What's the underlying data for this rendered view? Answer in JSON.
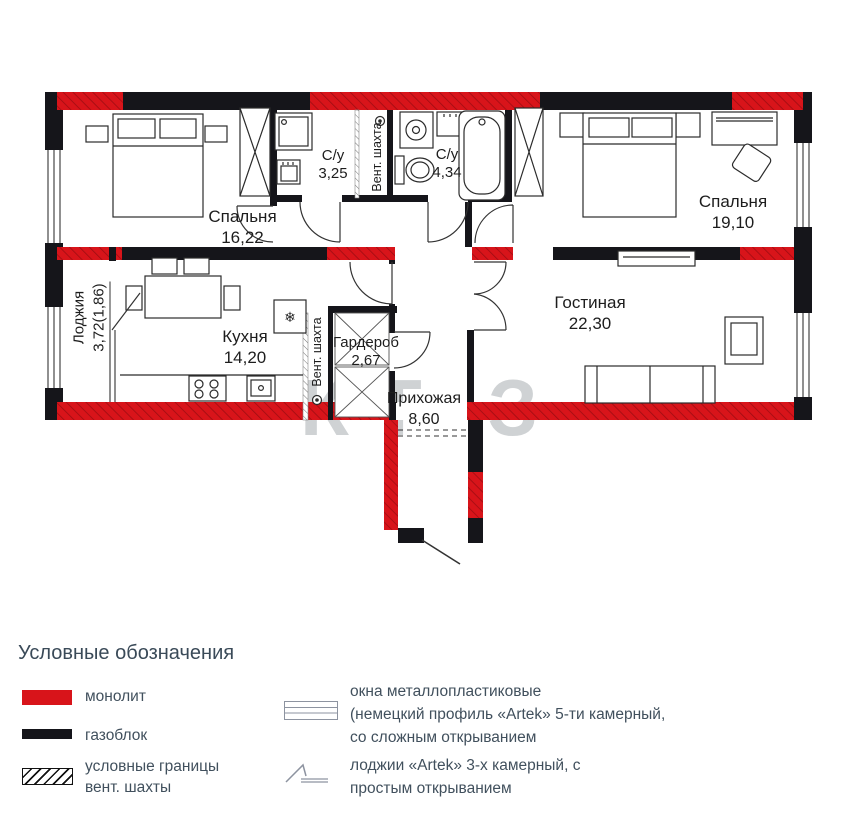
{
  "plan": {
    "rooms": {
      "bedroom1": {
        "name": "Спальня",
        "area": "16,22"
      },
      "bath1": {
        "name": "С/у",
        "area": "3,25"
      },
      "bath2": {
        "name": "С/у",
        "area": "4,34"
      },
      "bedroom2": {
        "name": "Спальня",
        "area": "19,10"
      },
      "living": {
        "name": "Гостиная",
        "area": "22,30"
      },
      "kitchen": {
        "name": "Кухня",
        "area": "14,20"
      },
      "wardrobe": {
        "name": "Гардероб",
        "area": "2,67"
      },
      "hallway": {
        "name": "Прихожая",
        "area": "8,60"
      },
      "loggia": {
        "name": "Лоджия",
        "area": "3,72(1,86)"
      }
    },
    "vent_shaft_top": "Вент. шахта",
    "vent_shaft_kitchen": "Вент. шахта",
    "fridge_icon": "❄",
    "watermark": "КТ З"
  },
  "legend": {
    "title": "Условные обозначения",
    "monolith": "монолит",
    "gasblock": "газоблок",
    "vent_borders_line1": "условные границы",
    "vent_borders_line2": "вент. шахты",
    "windows_line1": "окна металлопластиковые",
    "windows_line2": "(немецкий профиль «Artek» 5-ти камерный,",
    "windows_line3": "со сложным открыванием",
    "loggia_line1": "лоджии «Artek» 3-х камерный, с",
    "loggia_line2": "простым открыванием"
  },
  "colors": {
    "monolith": "#d8141a",
    "gasblock": "#15151a"
  }
}
